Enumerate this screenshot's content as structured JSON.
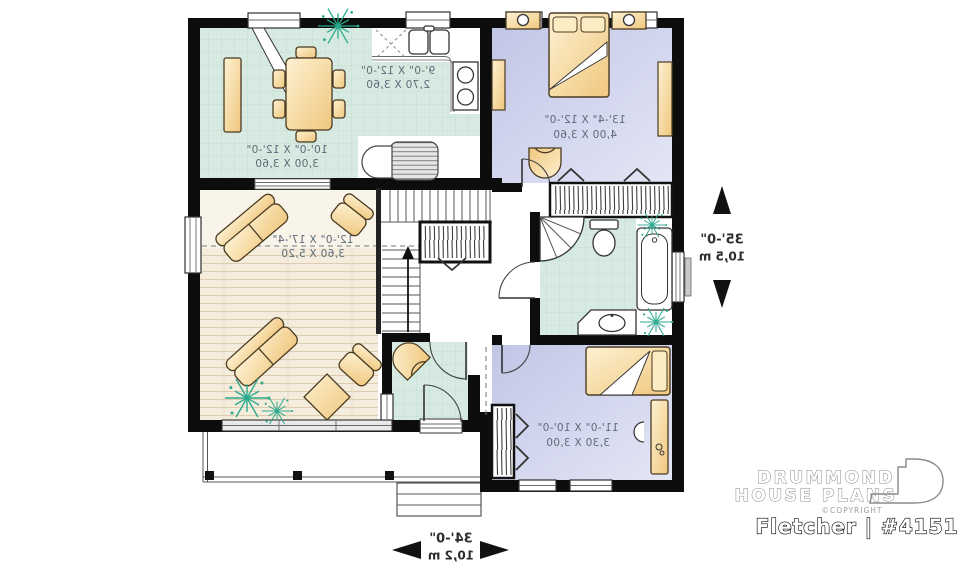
{
  "plan": {
    "name": "Fletcher | #4151"
  },
  "brand": {
    "line1": "DRUMMOND",
    "line2": "HOUSE PLANS",
    "copyright": "©COPYRIGHT"
  },
  "rooms": {
    "dining": {
      "imperial": "10'-0\" X 12'-0\"",
      "metric": "3,00 X 3,60"
    },
    "kitchen": {
      "imperial": "9'-0\" X 12'-0\"",
      "metric": "2,70 X 3,60"
    },
    "master_bedroom": {
      "imperial": "13'-4\" X 12'-0\"",
      "metric": "4,00 X 3,60"
    },
    "living": {
      "imperial": "12'-0\" X 17'-4\"",
      "metric": "3,60 X 5,20"
    },
    "bedroom_2": {
      "imperial": "11'-0\" X 10'-0\"",
      "metric": "3,30 X 3,00"
    }
  },
  "overall_dimensions": {
    "width_imperial": "34'-0\"",
    "width_metric": "10,2 m",
    "depth_imperial": "35'-0\"",
    "depth_metric": "10,5 m"
  },
  "colors": {
    "wall": "#0d0d0d",
    "tile_floor": "#d7eae1",
    "carpet_floor": "#c9cde9",
    "wood_floor": "#f4ecdc",
    "furniture": "#f6d9a0",
    "plant": "#2aa98d",
    "label_text": "#5c6b79"
  }
}
